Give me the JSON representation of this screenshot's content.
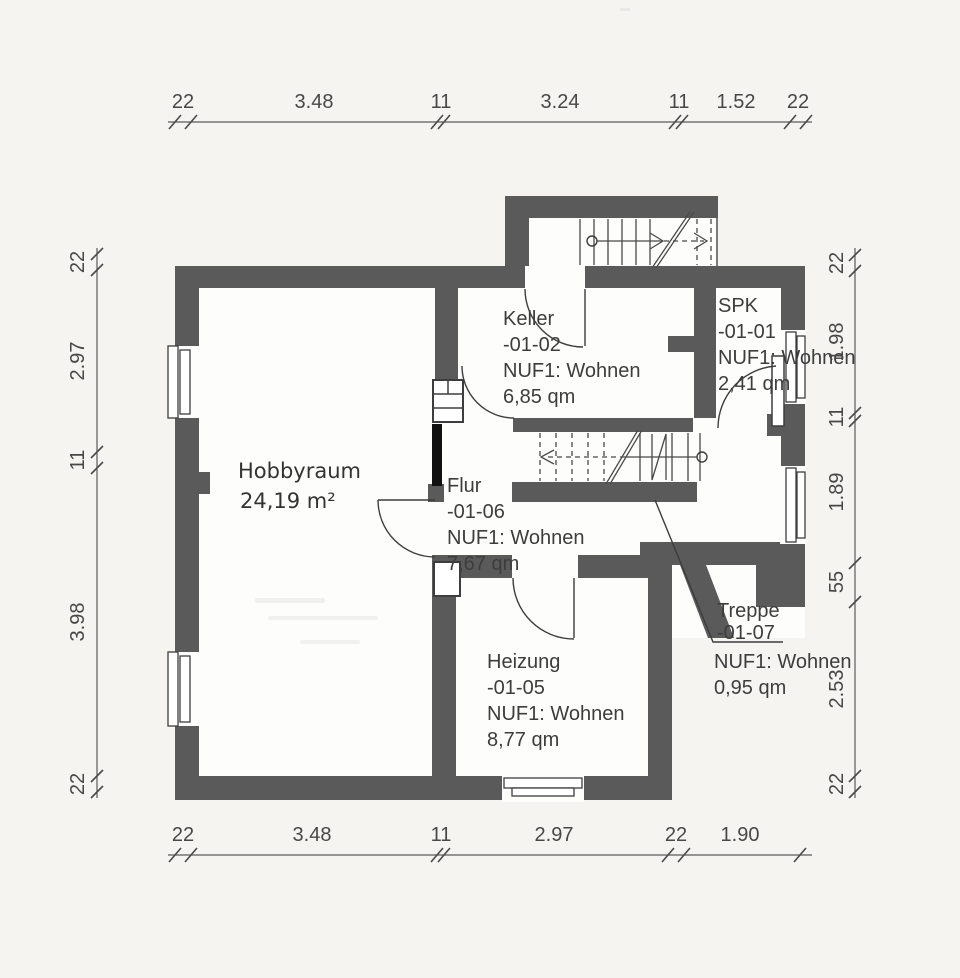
{
  "document": {
    "type": "basement floor plan scan",
    "language": "de"
  },
  "rooms": {
    "hobbyraum": {
      "name": "Hobbyraum",
      "area": "24,19 m²"
    },
    "keller": {
      "name": "Keller",
      "code": "-01-02",
      "usage": "NUF1: Wohnen",
      "area": "6,85 qm"
    },
    "spk": {
      "name": "SPK",
      "code": "-01-01",
      "usage": "NUF1: Wohnen",
      "area": "2,41 qm"
    },
    "flur": {
      "name": "Flur",
      "code": "-01-06",
      "usage": "NUF1: Wohnen",
      "area": "7,67 qm"
    },
    "heizung": {
      "name": "Heizung",
      "code": "-01-05",
      "usage": "NUF1: Wohnen",
      "area": "8,77 qm"
    },
    "treppe": {
      "name": "Treppe",
      "code": "-01-07",
      "usage": "NUF1: Wohnen",
      "area": "0,95 qm"
    }
  },
  "dimensions": {
    "top": [
      "22",
      "3.48",
      "11",
      "3.24",
      "11",
      "1.52",
      "22"
    ],
    "bottom": [
      "22",
      "3.48",
      "11",
      "2.97",
      "22",
      "1.90"
    ],
    "left": [
      "22",
      "2.97",
      "11",
      "3.98",
      "22"
    ],
    "right": [
      "22",
      "1.98",
      "11",
      "1.89",
      "55",
      "2.53",
      "22"
    ]
  },
  "colors": {
    "wall": "#5a5a5a",
    "ink": "#3d3d3d",
    "dim_text": "#474747",
    "paper": "#f5f4f1",
    "room_fill": "#fdfdfc"
  }
}
